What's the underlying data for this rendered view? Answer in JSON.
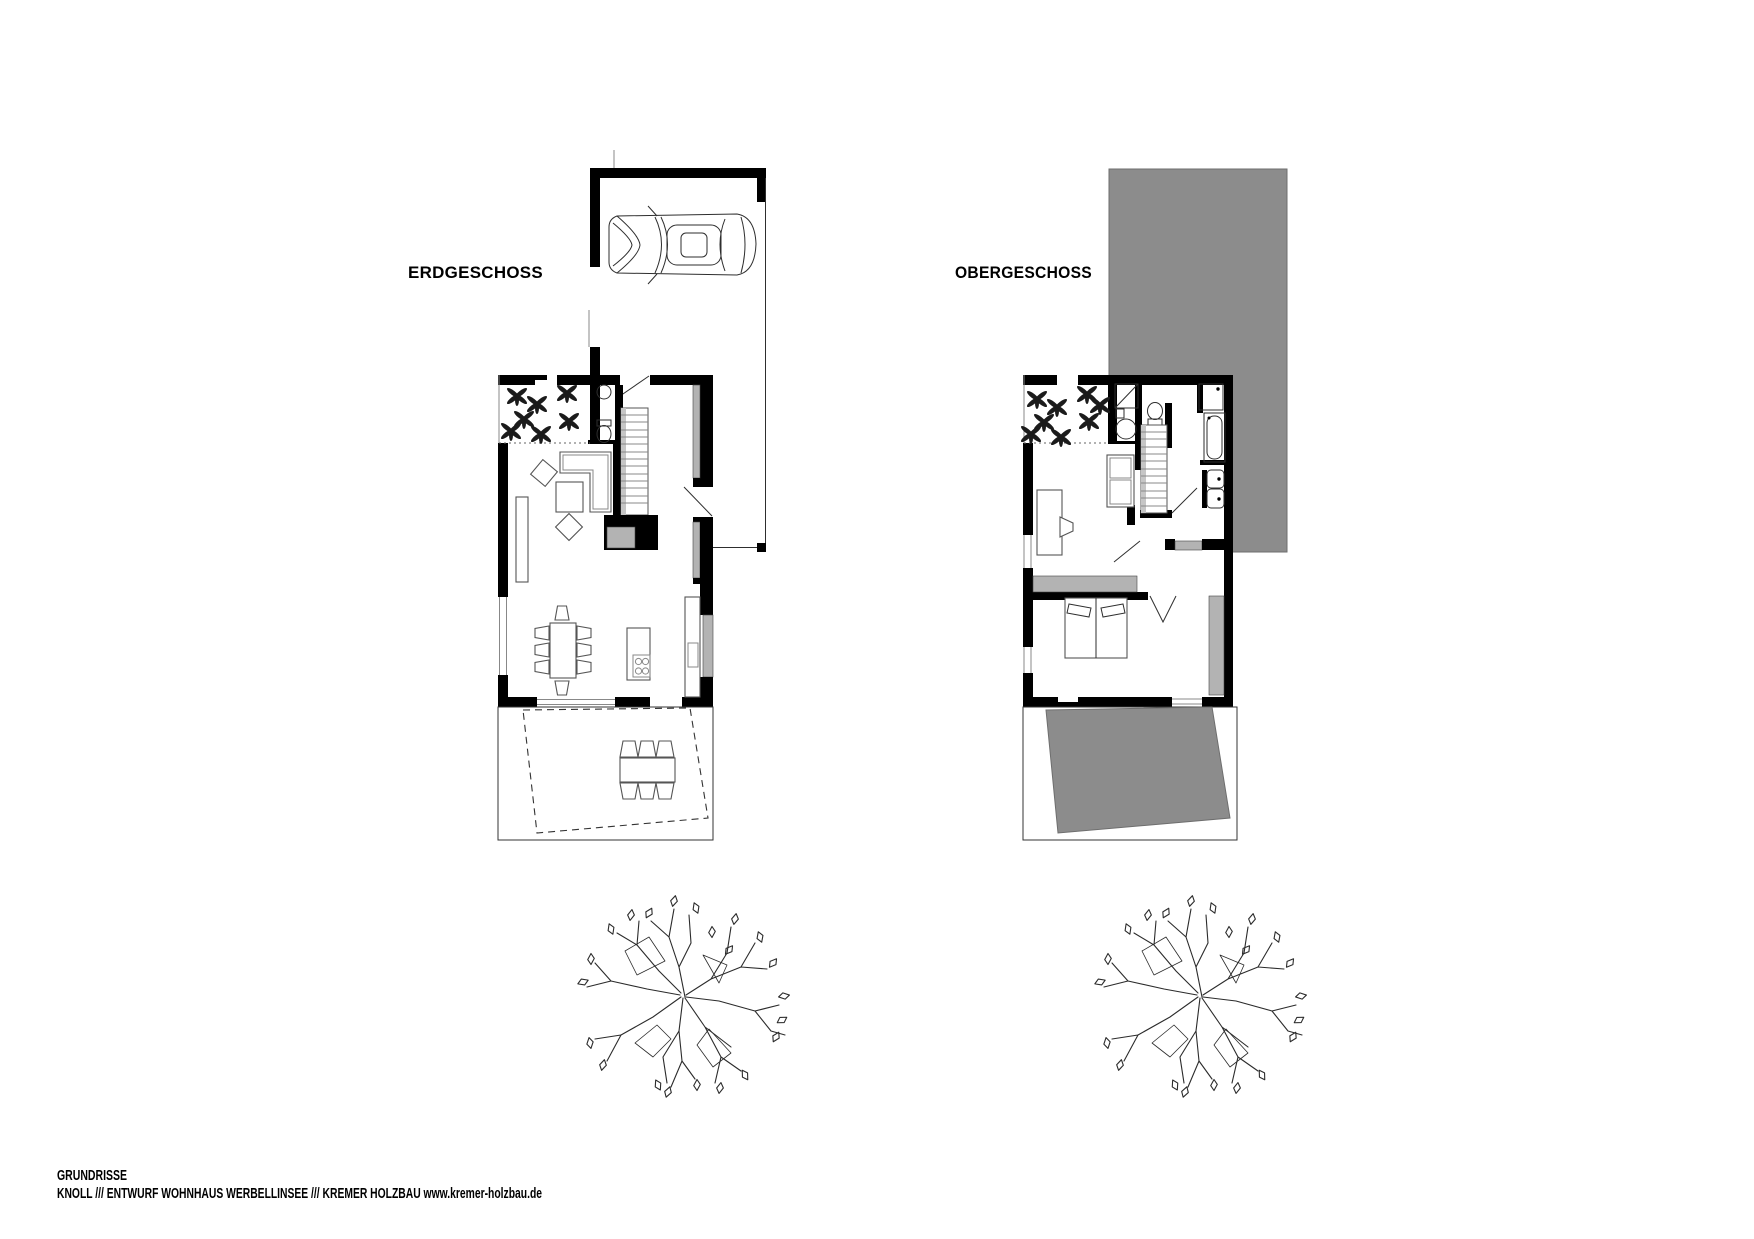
{
  "canvas": {
    "width": 1754,
    "height": 1239
  },
  "plans": {
    "left": {
      "label": "ERDGESCHOSS"
    },
    "right": {
      "label": "OBERGESCHOSS"
    }
  },
  "footer": {
    "line1": "GRUNDRISSE",
    "line2": "KNOLL /// ENTWURF WOHNHAUS WERBELLINSEE /// KREMER HOLZBAU www.kremer-holzbau.de"
  },
  "colors": {
    "background": "#ffffff",
    "wall": "#000000",
    "roof": "#8c8c8c",
    "sill": "#b3b3b3",
    "line": "#2e2e2e"
  }
}
